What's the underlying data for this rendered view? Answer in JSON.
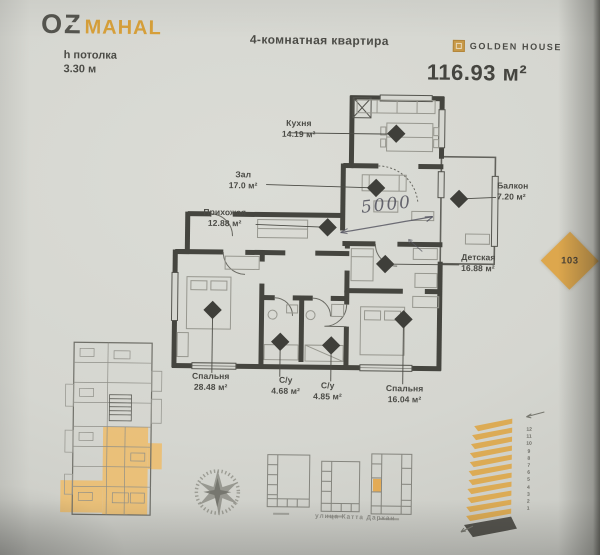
{
  "header": {
    "brand_primary": "OZ",
    "brand_secondary": "MAHAL",
    "ceiling_label": "h потолка",
    "ceiling_value": "3.30 м",
    "apartment_type": "4-комнатная квартира",
    "developer": "GOLDEN HOUSE",
    "total_area": "116.93 м²"
  },
  "plan": {
    "rooms": [
      {
        "name": "Кухня",
        "area": "14.19 м²"
      },
      {
        "name": "Зал",
        "area": "17.0 м²"
      },
      {
        "name": "Балкон",
        "area": "7.20 м²"
      },
      {
        "name": "Прихожая",
        "area": "12.88 м²"
      },
      {
        "name": "Детская",
        "area": "16.88 м²"
      },
      {
        "name": "Спальня",
        "area": "28.48 м²"
      },
      {
        "name": "С/у",
        "area": "4.68 м²"
      },
      {
        "name": "С/у",
        "area": "4.85 м²"
      },
      {
        "name": "Спальня",
        "area": "16.04 м²"
      }
    ],
    "handwritten_dimension": "5000",
    "apartment_number": "103"
  },
  "site": {
    "street": "улица Катта Дархан"
  },
  "elevation": {
    "floors": [
      "12",
      "11",
      "10",
      "9",
      "8",
      "7",
      "6",
      "5",
      "4",
      "3",
      "2",
      "1"
    ]
  },
  "colors": {
    "accent_gold": "#d7a03a",
    "highlight_orange": "#ecbe72",
    "ink": "#4b4b46"
  }
}
